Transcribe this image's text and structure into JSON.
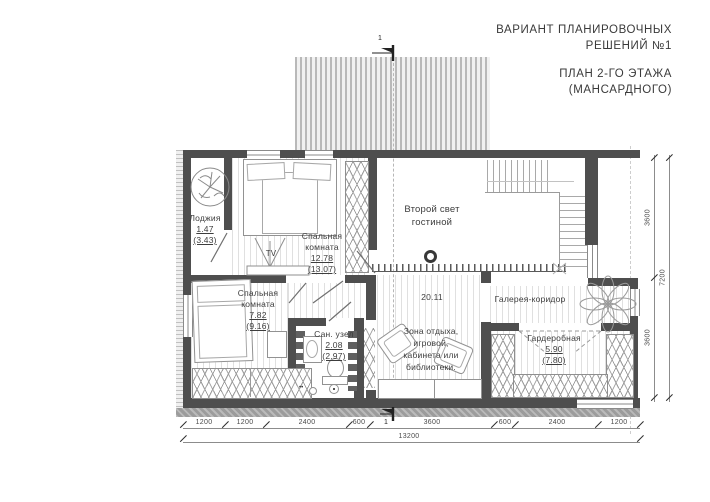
{
  "title_block": {
    "variant_line1": "ВАРИАНТ ПЛАНИРОВОЧНЫХ",
    "variant_line2": "РЕШЕНИЙ №1",
    "plan_line1": "ПЛАН 2-ГО ЭТАЖА",
    "plan_line2": "(МАНСАРДНОГО)"
  },
  "rooms": {
    "loggia": {
      "name": "Лоджия",
      "area": "1.47",
      "area_gross": "(3.43)"
    },
    "bedroom_top": {
      "name1": "Спальная",
      "name2": "комната",
      "area": "12.78",
      "area_gross": "(13.07)"
    },
    "bedroom_bottom": {
      "name1": "Спальная",
      "name2": "комната",
      "area": "7.82",
      "area_gross": "(9.16)"
    },
    "second_light": {
      "name1": "Второй свет",
      "name2": "гостиной"
    },
    "leisure_zone": {
      "area": "20.11",
      "desc1": "Зона отдыха,",
      "desc2": "игровой,",
      "desc3": "кабинета или",
      "desc4": "библиотеки."
    },
    "gallery_corridor": {
      "name": "Галерея-коридор"
    },
    "bathroom": {
      "name": "Сан. узел",
      "area": "2.08",
      "area_gross": "(2.97)"
    },
    "wardrobe": {
      "name": "Гардеробная",
      "area": "5.90",
      "area_gross": "(7.80)"
    }
  },
  "furniture": {
    "tv": "TV"
  },
  "dimensions": {
    "bottom": [
      "1200",
      "1200",
      "2400",
      "600",
      "3600",
      "600",
      "2400",
      "1200"
    ],
    "bottom_total": "13200",
    "right": [
      "3600",
      "3600"
    ],
    "right_total": "7200"
  },
  "section_marks": {
    "top": "1",
    "bottom": "1"
  },
  "colors": {
    "wall": "#4e4e4e",
    "text": "#3d3d3d",
    "dim_text": "#4a4a4a",
    "hatch_stripe": "#b9b9b9"
  }
}
